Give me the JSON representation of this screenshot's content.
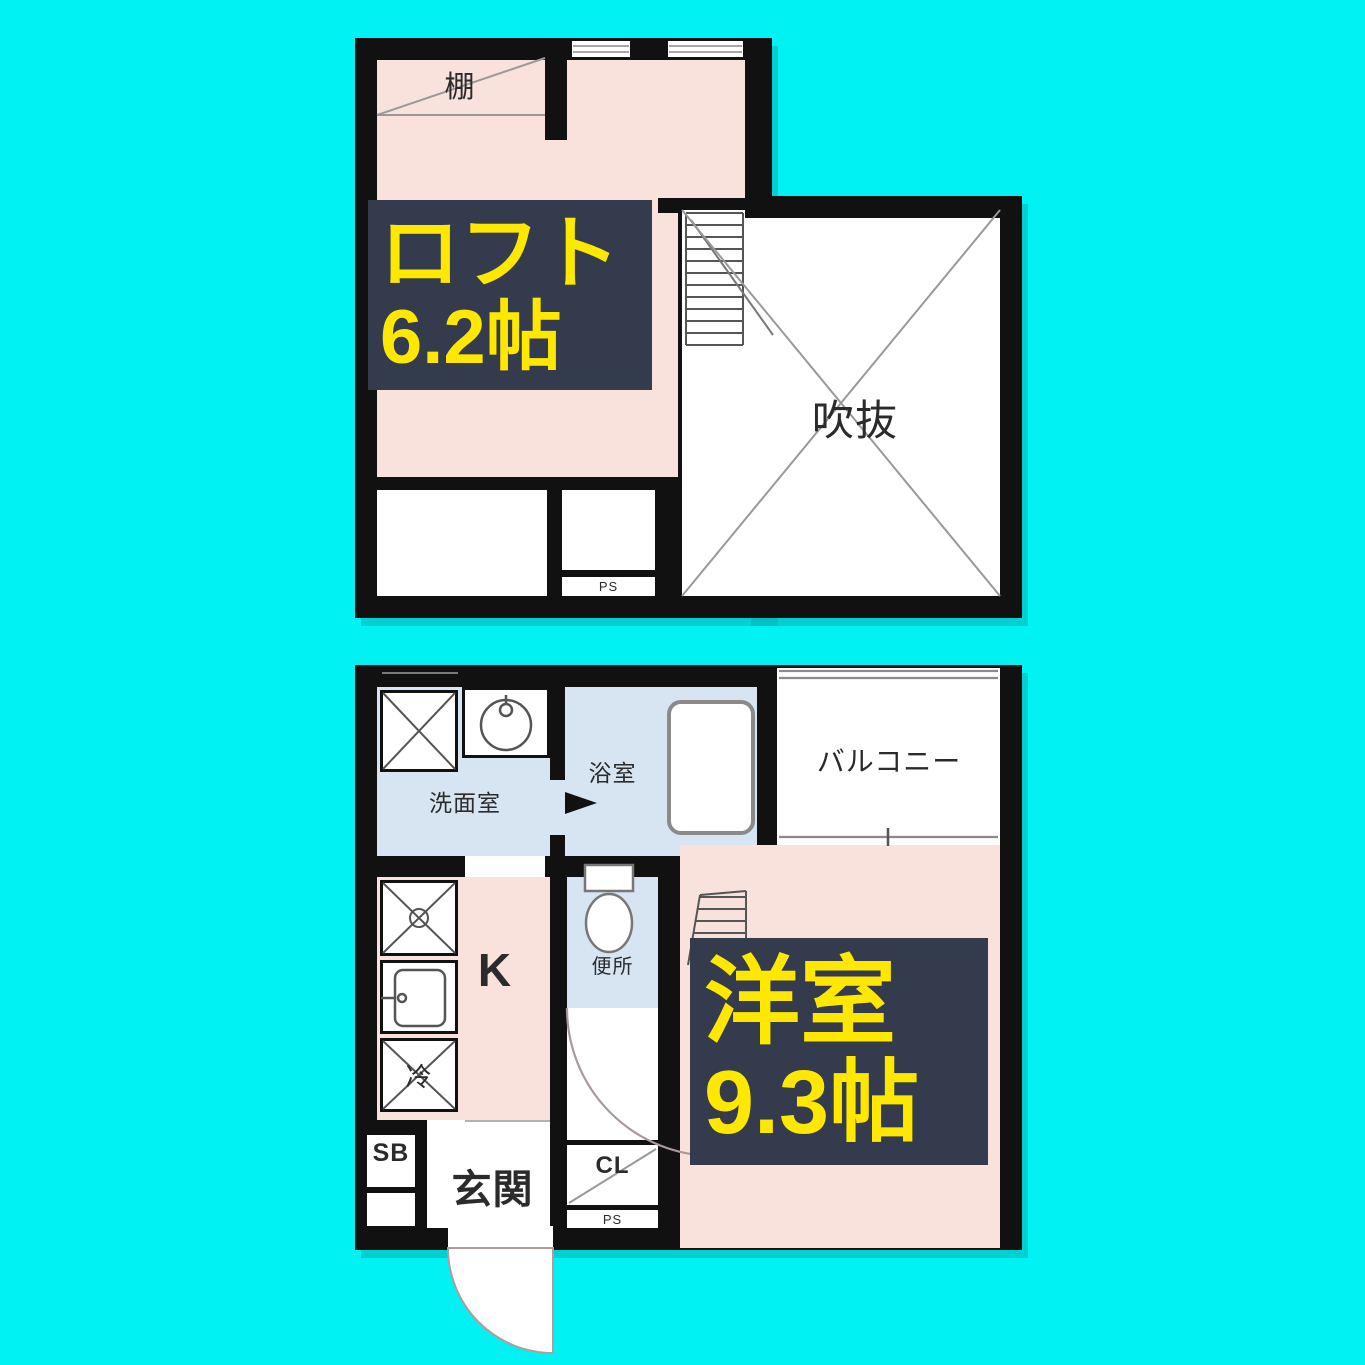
{
  "colors": {
    "background": "#00F2F2",
    "floor_pink": "#FAE2DC",
    "wet_area_blue": "#D7E5F2",
    "wall_black": "#111111",
    "label_box_navy": "#333B4C",
    "label_text_yellow": "#FFE800"
  },
  "upper_plan": {
    "shelf": "棚",
    "loft_name": "ロフト",
    "loft_size": "6.2帖",
    "void": "吹抜",
    "pipe_space": "PS"
  },
  "lower_plan": {
    "washroom": "洗面室",
    "bathroom": "浴室",
    "balcony": "バルコニー",
    "kitchen": "K",
    "toilet": "便所",
    "fridge": "冷",
    "room_name": "洋室",
    "room_size": "9.3帖",
    "shoe_box": "SB",
    "entrance": "玄関",
    "closet": "CL",
    "pipe_space": "PS"
  }
}
